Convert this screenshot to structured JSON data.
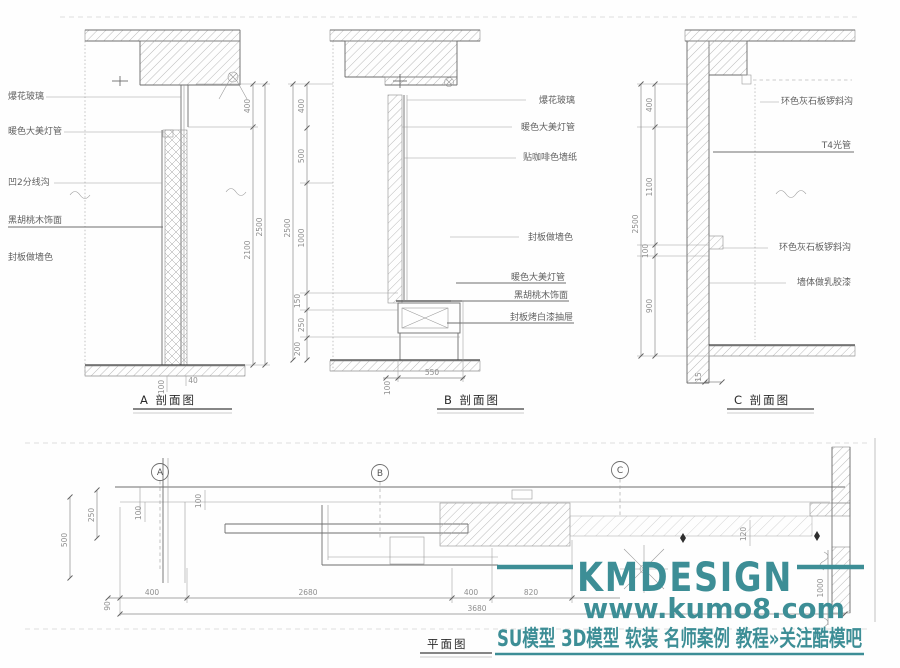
{
  "watermark": {
    "brand": "KMDESIGN",
    "url": "www.kumo8.com",
    "tagline": "SU模型 3D模型 软装 名师案例 教程»关注酷模吧",
    "color": "#3d8e96"
  },
  "sections": {
    "a": {
      "title": "A 剖面图",
      "labels": [
        "爆花玻璃",
        "暖色大美灯管",
        "凹2分线沟",
        "黑胡桃木饰面",
        "封板做墙色"
      ],
      "dim_total": "2500",
      "dim_segments": [
        "400",
        "2100"
      ],
      "bottom_dims": [
        "100",
        "40"
      ]
    },
    "b": {
      "title": "B 剖面图",
      "labels": [
        "爆花玻璃",
        "暖色大美灯管",
        "贴咖啡色墙纸",
        "封板做墙色",
        "暖色大美灯管",
        "黑胡桃木饰面",
        "封板烤白漆抽屉"
      ],
      "dim_total": "2500",
      "dim_segments": [
        "400",
        "500",
        "1000",
        "150",
        "250",
        "200"
      ],
      "bottom_dims": [
        "100",
        "550"
      ]
    },
    "c": {
      "title": "C 剖面图",
      "labels": [
        "环色灰石板锣斜沟",
        "T4光管",
        "环色灰石板锣斜沟",
        "墙体做乳胶漆"
      ],
      "dim_total": "2500",
      "dim_segments": [
        "400",
        "1100",
        "100",
        "900"
      ],
      "bottom_dims": [
        "15"
      ]
    }
  },
  "plan": {
    "title": "平面图",
    "markers": [
      "A",
      "B",
      "C"
    ],
    "dims": {
      "left": [
        "250",
        "500"
      ],
      "small": [
        "100",
        "100",
        "120"
      ],
      "bottom": [
        "90",
        "400",
        "2680",
        "400",
        "820"
      ],
      "total": "3680",
      "right": "1000"
    }
  }
}
